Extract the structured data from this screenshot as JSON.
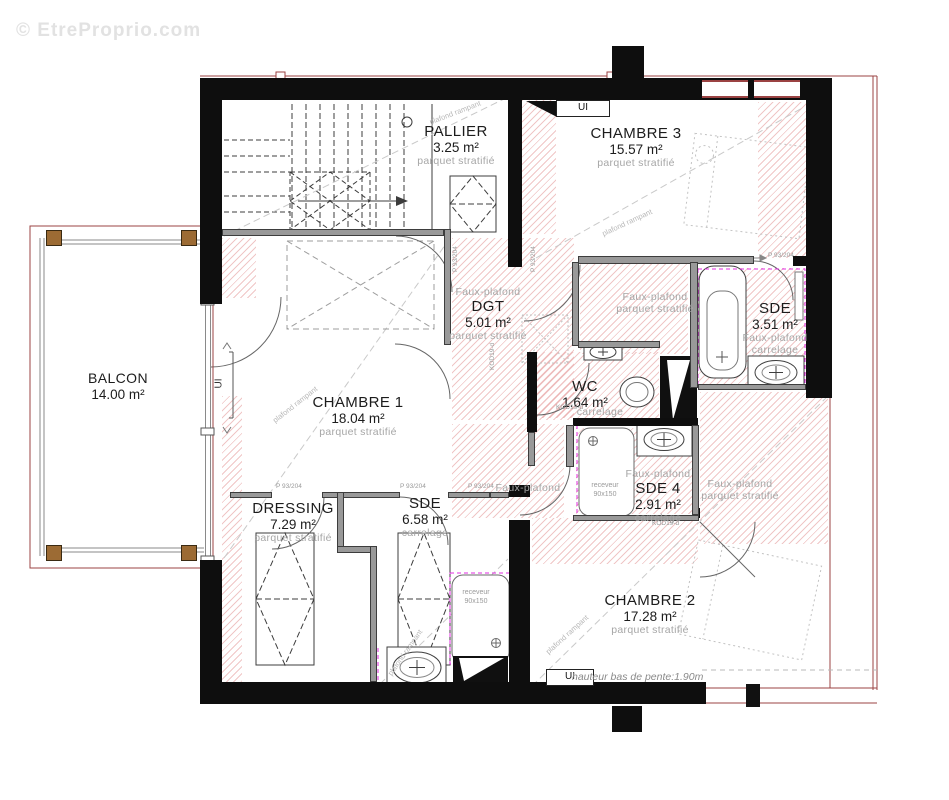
{
  "watermark": "© EtreProprio.com",
  "rooms": {
    "pallier": {
      "name": "PALLIER",
      "area": "3.25 m²",
      "floor": "parquet stratifié"
    },
    "chambre3": {
      "name": "CHAMBRE 3",
      "area": "15.57 m²",
      "floor": "parquet stratifié"
    },
    "dgt": {
      "ceiling": "Faux-plafond",
      "name": "DGT",
      "area": "5.01 m²",
      "floor": "parquet stratifié"
    },
    "couloir": {
      "ceiling": "Faux-plafond",
      "floor": "parquet stratifié"
    },
    "sde": {
      "name": "SDE",
      "area": "3.51 m²",
      "ceiling": "Faux-plafond",
      "floor": "carrelage"
    },
    "wc": {
      "name": "WC",
      "area": "1.64 m²",
      "floor": "carrelage"
    },
    "chambre1": {
      "name": "CHAMBRE 1",
      "area": "18.04 m²",
      "floor": "parquet stratifié"
    },
    "sde4": {
      "ceiling": "Faux-plafond",
      "name": "SDE 4",
      "area": "2.91 m²",
      "floor": "carrelage"
    },
    "faux_left": {
      "ceiling": "Faux-plafond"
    },
    "faux_right": {
      "ceiling": "Faux-plafond",
      "floor": "parquet stratifié"
    },
    "dressing": {
      "name": "DRESSING",
      "area": "7.29 m²",
      "floor": "parquet stratifié"
    },
    "sde_bas": {
      "name": "SDE",
      "area": "6.58 m²",
      "floor": "carrelage"
    },
    "chambre2": {
      "name": "CHAMBRE 2",
      "area": "17.28 m²",
      "floor": "parquet stratifié"
    },
    "balcon": {
      "name": "BALCON",
      "area": "14.00 m²"
    }
  },
  "annotations": {
    "slope_note": "hauteur bas de pente:1.90m",
    "ui": "UI",
    "door_code": "P 93/204",
    "fixture_code": "KOD19-d",
    "shower_line1": "receveur",
    "shower_line2": "90x150",
    "rampant": "plafond rampant"
  },
  "colors": {
    "wall": "#0e0e0e",
    "roof_line": "#9b4343",
    "hatch": "#d66262",
    "renovation_outline": "#e22ee2",
    "wood_post": "#9c6b34",
    "gray_wall": "#999999",
    "label_gray": "#a6a6a6"
  }
}
